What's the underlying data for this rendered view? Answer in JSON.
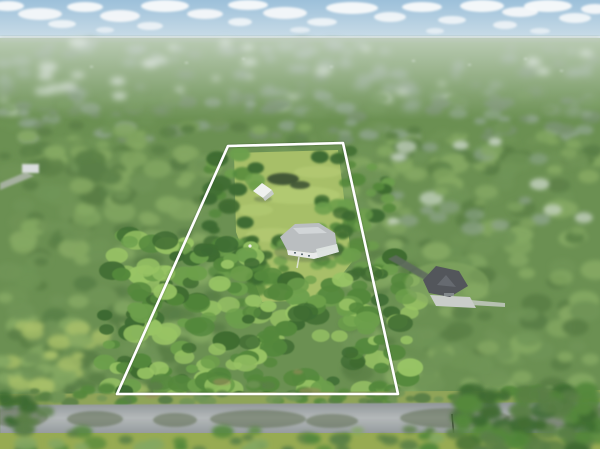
{
  "photo": {
    "kind": "aerial-drone-photograph",
    "description": "Aerial view of a wooded residential lot outlined with a white property-boundary overlay; single-story home and small white outbuilding inside the lot, paved street along the bottom, neighboring home with dark roof to the right, hazy tree-covered horizon with scattered clouds."
  },
  "palette": {
    "sky_top": "#9cc0da",
    "sky_horizon": "#d3e2ea",
    "cloud": "#f8fafb",
    "haze": "#eef3f5",
    "base_green": "#6b9052",
    "far_forest": "#8ba387",
    "far_forest_dark": "#78926f",
    "far_pale": "#ccd8cb",
    "glint": "#e8ecea",
    "mid_green_dark": "#5a7f46",
    "mid_green": "#6f9456",
    "mid_green_light": "#84a862",
    "sharp_dark": "#3e6b31",
    "sharp_mid": "#54883b",
    "sharp_light": "#6c9f4b",
    "sharp_hi": "#98c464",
    "lawn": "#a7bf68",
    "lawn_light": "#bdd47c",
    "shoulder": "#8fa458",
    "ground_front": "#97ab52",
    "road_light": "#b3b8b9",
    "road_dark": "#8f9597",
    "shadow_olive": "#556548",
    "boundary": "#ffffff",
    "main_roof": "#babec0",
    "main_roof_hi": "#d4d7d9",
    "main_wall": "#e9ebea",
    "lanai": "#dde4e0",
    "window_dark": "#5d6d74",
    "shed": "#eff1ef",
    "shed_side": "#c6ccc8",
    "neighbor_roof": "#53565b",
    "neighbor_gable": "#666a70",
    "pad": "#c9cdc9",
    "drive_dark": "#5f6b5f",
    "building_white": "#d9dddd",
    "pale_drive": "#b4b9b2",
    "pond": "#33462e",
    "trail": "#9a8c5c",
    "pole": "#3b4337"
  },
  "boundary": {
    "points_str": "228,146 343,143 398,394 117,394",
    "stroke_width": 2.6
  },
  "objects": [
    {
      "name": "main-house",
      "desc": "single-story home, light gray hip roof, white walls, rear screened lanai"
    },
    {
      "name": "guest-shed",
      "desc": "small white outbuilding north of the main house"
    },
    {
      "name": "neighbor-house",
      "desc": "neighboring home with dark charcoal roof, driveway and pale parking pad"
    },
    {
      "name": "street",
      "desc": "gray paved road crossing the bottom of the frame with tree shadows"
    },
    {
      "name": "far-left-building",
      "desc": "small white structure near left edge"
    },
    {
      "name": "utility-pole",
      "desc": "thin pole at road edge right of center"
    }
  ],
  "clouds": [
    [
      8,
      6,
      16,
      5,
      0.95
    ],
    [
      40,
      14,
      22,
      6,
      0.9
    ],
    [
      85,
      7,
      18,
      5,
      0.95
    ],
    [
      62,
      24,
      14,
      4,
      0.8
    ],
    [
      120,
      16,
      20,
      6,
      0.9
    ],
    [
      165,
      6,
      24,
      6,
      0.95
    ],
    [
      150,
      26,
      13,
      4,
      0.75
    ],
    [
      205,
      14,
      18,
      5,
      0.9
    ],
    [
      248,
      5,
      20,
      5,
      0.95
    ],
    [
      240,
      22,
      12,
      4,
      0.8
    ],
    [
      285,
      13,
      22,
      6,
      0.9
    ],
    [
      322,
      22,
      15,
      4,
      0.8
    ],
    [
      352,
      8,
      26,
      6,
      0.95
    ],
    [
      390,
      17,
      16,
      5,
      0.85
    ],
    [
      422,
      7,
      20,
      5,
      0.95
    ],
    [
      452,
      20,
      14,
      4,
      0.8
    ],
    [
      482,
      6,
      22,
      6,
      0.95
    ],
    [
      505,
      25,
      12,
      4,
      0.75
    ],
    [
      520,
      12,
      18,
      5,
      0.9
    ],
    [
      548,
      6,
      24,
      6,
      0.95
    ],
    [
      575,
      18,
      16,
      5,
      0.85
    ],
    [
      595,
      9,
      14,
      5,
      0.9
    ],
    [
      300,
      30,
      10,
      3,
      0.6
    ],
    [
      105,
      30,
      9,
      3,
      0.6
    ],
    [
      435,
      31,
      9,
      3,
      0.6
    ],
    [
      540,
      31,
      10,
      3,
      0.6
    ]
  ],
  "glints": [
    [
      185,
      62
    ],
    [
      242,
      58
    ],
    [
      330,
      66
    ],
    [
      412,
      60
    ],
    [
      468,
      64
    ],
    [
      524,
      58
    ],
    [
      90,
      66
    ],
    [
      560,
      70
    ]
  ],
  "lawn": {
    "streaks": [
      [
        298,
        195,
        42,
        9,
        0.45
      ],
      [
        272,
        235,
        26,
        7,
        0.4
      ],
      [
        318,
        172,
        24,
        6,
        0.4
      ],
      [
        255,
        210,
        18,
        6,
        0.35
      ]
    ]
  },
  "road_shadows": [
    [
      18,
      417,
      30,
      10
    ],
    [
      95,
      419,
      28,
      8
    ],
    [
      175,
      420,
      22,
      7
    ],
    [
      258,
      419,
      48,
      9
    ],
    [
      332,
      421,
      26,
      7
    ],
    [
      455,
      418,
      55,
      10
    ],
    [
      545,
      420,
      42,
      9
    ],
    [
      598,
      416,
      30,
      9
    ]
  ],
  "dirt_patches": [
    [
      222,
      382,
      9,
      3.5
    ],
    [
      310,
      391,
      11,
      3.5
    ],
    [
      298,
      372,
      5,
      2.5
    ],
    [
      152,
      396,
      7,
      2.5
    ]
  ],
  "foliage_bands": [
    {
      "layer": "L-far",
      "x": 0,
      "y": 42,
      "w": 600,
      "h": 70,
      "count": 140,
      "rmin": 4,
      "rmax": 10,
      "squash": 0.5,
      "blur": "fb3",
      "colors": [
        "far_forest",
        "far_forest_dark",
        "far_forest",
        "far_pale"
      ],
      "op": 0.9
    },
    {
      "layer": "L-far",
      "x": 0,
      "y": 96,
      "w": 600,
      "h": 45,
      "count": 110,
      "rmin": 5,
      "rmax": 11,
      "squash": 0.55,
      "blur": "fb2",
      "colors": [
        "far_forest_dark",
        "mid_green",
        "far_forest"
      ],
      "op": 0.95
    },
    {
      "layer": "L-mid",
      "x": 0,
      "y": 125,
      "w": 600,
      "h": 45,
      "count": 110,
      "rmin": 5,
      "rmax": 12,
      "squash": 0.6,
      "blur": "fb2",
      "colors": [
        "mid_green",
        "mid_green_dark",
        "mid_green_light"
      ]
    },
    {
      "layer": "L-mid",
      "x": 0,
      "y": 150,
      "w": 225,
      "h": 255,
      "count": 180,
      "rmin": 7,
      "rmax": 16,
      "squash": 0.65,
      "blur": "fb2",
      "colors": [
        "mid_green_dark",
        "mid_green",
        "mid_green_light"
      ]
    },
    {
      "layer": "L-mid",
      "x": 348,
      "y": 150,
      "w": 252,
      "h": 265,
      "count": 180,
      "rmin": 7,
      "rmax": 16,
      "squash": 0.65,
      "blur": "fb2",
      "colors": [
        "mid_green_dark",
        "mid_green",
        "mid_green_light"
      ]
    },
    {
      "layer": "L-mid",
      "x": 390,
      "y": 138,
      "w": 210,
      "h": 95,
      "count": 38,
      "rmin": 5,
      "rmax": 12,
      "squash": 0.6,
      "blur": "fb2",
      "colors": [
        "far_pale",
        "mid_green_light",
        "far_forest"
      ],
      "op": 0.85
    },
    {
      "layer": "L-mid",
      "x": 0,
      "y": 318,
      "w": 140,
      "h": 82,
      "count": 50,
      "rmin": 6,
      "rmax": 13,
      "squash": 0.6,
      "blur": "fb2",
      "colors": [
        "mid_green_light",
        "lawn",
        "mid_green"
      ]
    },
    {
      "layer": "L-lotupper",
      "x": 208,
      "y": 150,
      "w": 50,
      "h": 165,
      "count": 45,
      "rmin": 5,
      "rmax": 11,
      "squash": 0.7,
      "blur": "fb1",
      "colors": [
        "sharp_mid",
        "sharp_dark",
        "sharp_light"
      ]
    },
    {
      "layer": "L-lotupper",
      "x": 315,
      "y": 148,
      "w": 75,
      "h": 125,
      "count": 50,
      "rmin": 5,
      "rmax": 11,
      "squash": 0.7,
      "blur": "fb1",
      "colors": [
        "sharp_mid",
        "sharp_dark",
        "sharp_light"
      ]
    },
    {
      "layer": "L-lotupper",
      "x": 246,
      "y": 230,
      "w": 50,
      "h": 58,
      "count": 20,
      "rmin": 5,
      "rmax": 10,
      "squash": 0.7,
      "blur": "fb1",
      "colors": [
        "sharp_dark",
        "sharp_mid",
        "sharp_light"
      ]
    },
    {
      "layer": "L-sharp",
      "x": 103,
      "y": 235,
      "w": 315,
      "h": 165,
      "count": 240,
      "rmin": 6,
      "rmax": 14,
      "squash": 0.7,
      "blur": "fb0",
      "colors": [
        "sharp_dark",
        "sharp_mid",
        "sharp_light",
        "sharp_hi"
      ],
      "keep_clear": [
        252,
        186,
        93,
        86
      ]
    },
    {
      "layer": "L-roadside",
      "x": 0,
      "y": 384,
      "w": 600,
      "h": 20,
      "count": 70,
      "rmin": 4,
      "rmax": 9,
      "squash": 0.6,
      "blur": "fb1",
      "colors": [
        "mid_green_dark",
        "mid_green",
        "sharp_mid"
      ]
    },
    {
      "layer": "L-fore",
      "x": 0,
      "y": 429,
      "w": 600,
      "h": 22,
      "count": 60,
      "rmin": 5,
      "rmax": 12,
      "squash": 0.6,
      "blur": "fb2",
      "colors": [
        "mid_green_dark",
        "sharp_mid",
        "mid_green_light"
      ]
    },
    {
      "layer": "L-fore",
      "x": 460,
      "y": 390,
      "w": 140,
      "h": 62,
      "count": 75,
      "rmin": 7,
      "rmax": 14,
      "squash": 0.7,
      "blur": "fb2",
      "colors": [
        "sharp_dark",
        "mid_green_dark",
        "sharp_mid"
      ]
    },
    {
      "layer": "L-fore",
      "x": 0,
      "y": 396,
      "w": 50,
      "h": 28,
      "count": 16,
      "rmin": 5,
      "rmax": 10,
      "squash": 0.65,
      "blur": "fb2",
      "colors": [
        "sharp_dark",
        "mid_green_dark"
      ]
    }
  ]
}
